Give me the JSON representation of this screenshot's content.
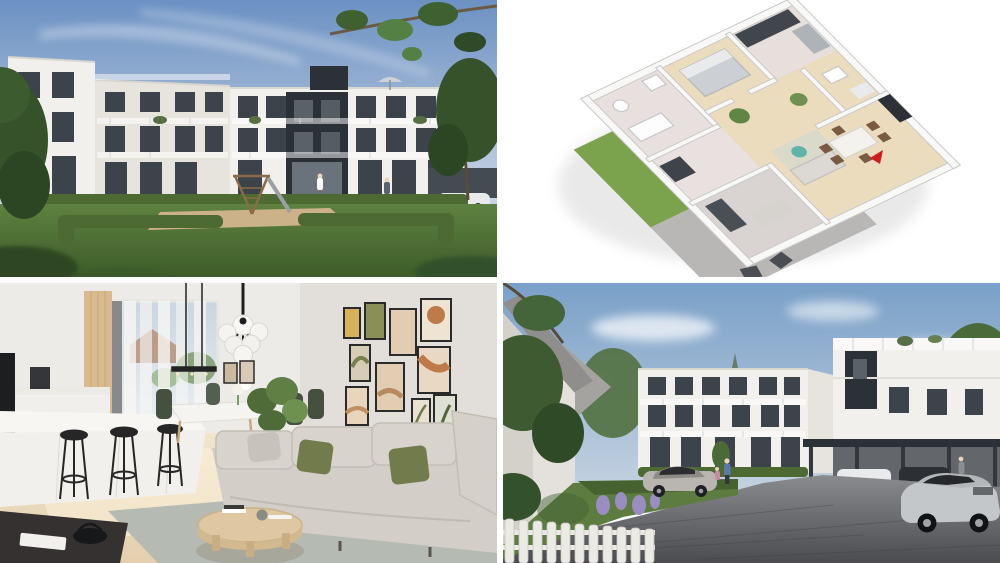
{
  "collage": {
    "grid": "2x2",
    "divider_color": "#ffffff",
    "panels": [
      {
        "name": "exterior-courtyard",
        "description": "Modern white apartment building with dark anthracite facade section, glass balconies, hedges, lawn and wooden playground under blue sky"
      },
      {
        "name": "floor-plan-3d",
        "description": "Isometric 3D floor plan with wood floors, white walls, furniture, terrace with chairs, lawn strip and red entrance arrow on white background"
      },
      {
        "name": "interior-living-room",
        "description": "Open-plan living room with white kitchen bar and black stools, globe chandelier, dining set, gallery wall of framed art and beige sofa with green pillows"
      },
      {
        "name": "exterior-parking",
        "description": "Residential courtyard with white buildings, carport with parked cars, silver SUV, cobblestone drive, garden and white picket fence"
      }
    ]
  },
  "palette": {
    "divider": "#ffffff",
    "skyTop": "#6b91c3",
    "skyLight": "#cfd9e6",
    "cloud": "#ffffff",
    "buildingWhite": "#f2f0ec",
    "buildingShade": "#e7e4de",
    "darkFacade": "#2c3138",
    "windowGlass": "#3d434b",
    "grass": "#5d7d40",
    "grassDark": "#3f5f2a",
    "hedge": "#4c6a31",
    "treeDark": "#35522a",
    "sand": "#ccb289",
    "playFrameWood": "#8a6b46",
    "planFloor": "#eadcbd",
    "planWall": "#f8f8f7",
    "planWallEdge": "#c9c9c9",
    "planTerrace": "#b9b7b5",
    "planLawn": "#7ba24d",
    "redMarker": "#cf1d1d",
    "chairBrown": "#7a5a40",
    "interiorWall": "#edebe7",
    "galleryWall": "#e2dfda",
    "woodPanel": "#d9ba8e",
    "floorWood": "#f0e2c8",
    "rug": "#b5bab2",
    "sofa": "#d3cfc8",
    "pillowGreen": "#727b4b",
    "tableWood": "#dfc7a1",
    "frameBlack": "#2a2a2a",
    "artMustard": "#d8b25a",
    "artOlive": "#8a8f58",
    "artTerracotta": "#bf7a4a",
    "artBeige": "#e3cdb2",
    "curtain": "#f7f6f4",
    "glazing": "#cad5df",
    "pavementLight": "#8a8b8e",
    "pavementDark": "#4b4c50",
    "carSilver": "#c4c7ca",
    "carWhite": "#e9eaec",
    "carDark": "#2c2f33",
    "carportFrame": "#34383d",
    "fenceWhite": "#eceae5",
    "lavender": "#9b8cc2"
  }
}
